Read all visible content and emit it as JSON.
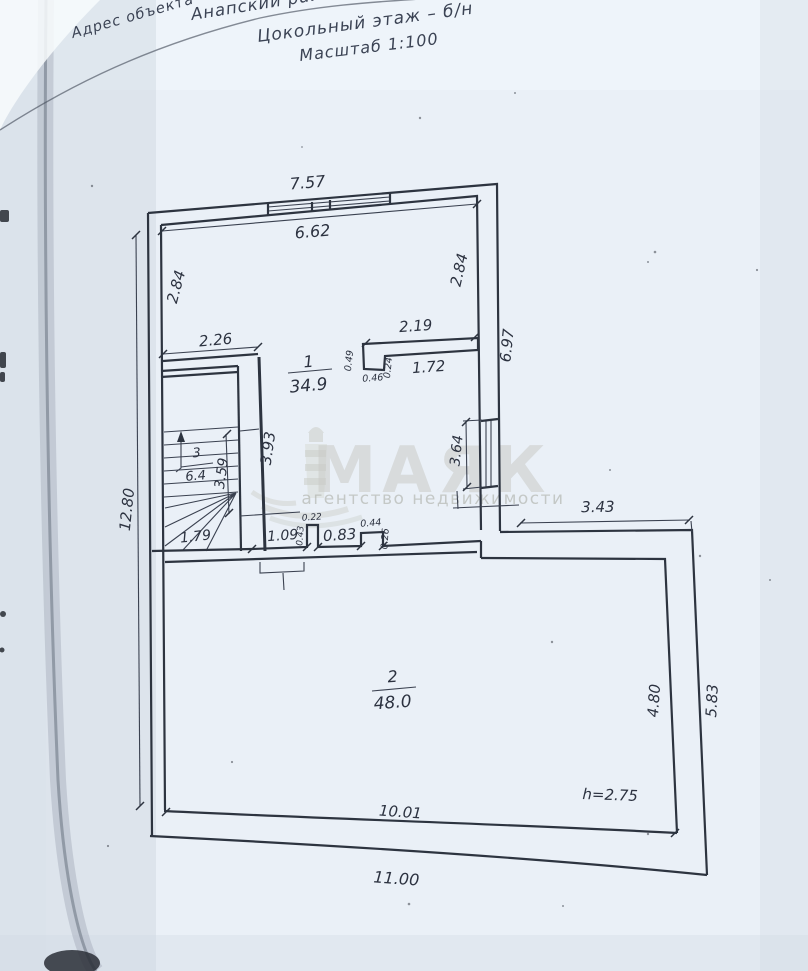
{
  "document": {
    "address_label": "Адрес объекта",
    "district": "Анапский район,",
    "floor_title": "Цокольный этаж – б/н",
    "scale": "Масштаб 1:100"
  },
  "watermark": {
    "brand": "МАЯК",
    "tagline": "агентство недвижимости",
    "icon": "lighthouse-icon"
  },
  "rooms": [
    {
      "number": "1",
      "area": "34.9"
    },
    {
      "number": "2",
      "area": "48.0"
    },
    {
      "number": "3",
      "area": "6.4"
    }
  ],
  "dims": {
    "top_outer": "7.57",
    "top_inner": "6.62",
    "left_upper": "2.84",
    "right_upper": "2.84",
    "right_outer": "6.97",
    "partition_top": "2.26",
    "niche_top": "2.19",
    "niche_left": "0.49",
    "niche_bottom": "0.46",
    "niche_step": "0.24",
    "niche_inner": "1.72",
    "stair_inner": "3.59",
    "stair_wall": "3.93",
    "stair_bottom": "1.79",
    "left_total": "12.80",
    "window_right": "3.64",
    "open_a": "1.09",
    "open_a_h": "0.43",
    "open_b": "0.22",
    "open_c": "0.83",
    "open_d": "0.44",
    "open_d_h": "0.26",
    "r2_top": "3.43",
    "r2_right_inner": "4.80",
    "r2_right_outer": "5.83",
    "r2_bottom_inner": "10.01",
    "r2_bottom_outer": "11.00",
    "height": "h=2.75"
  }
}
